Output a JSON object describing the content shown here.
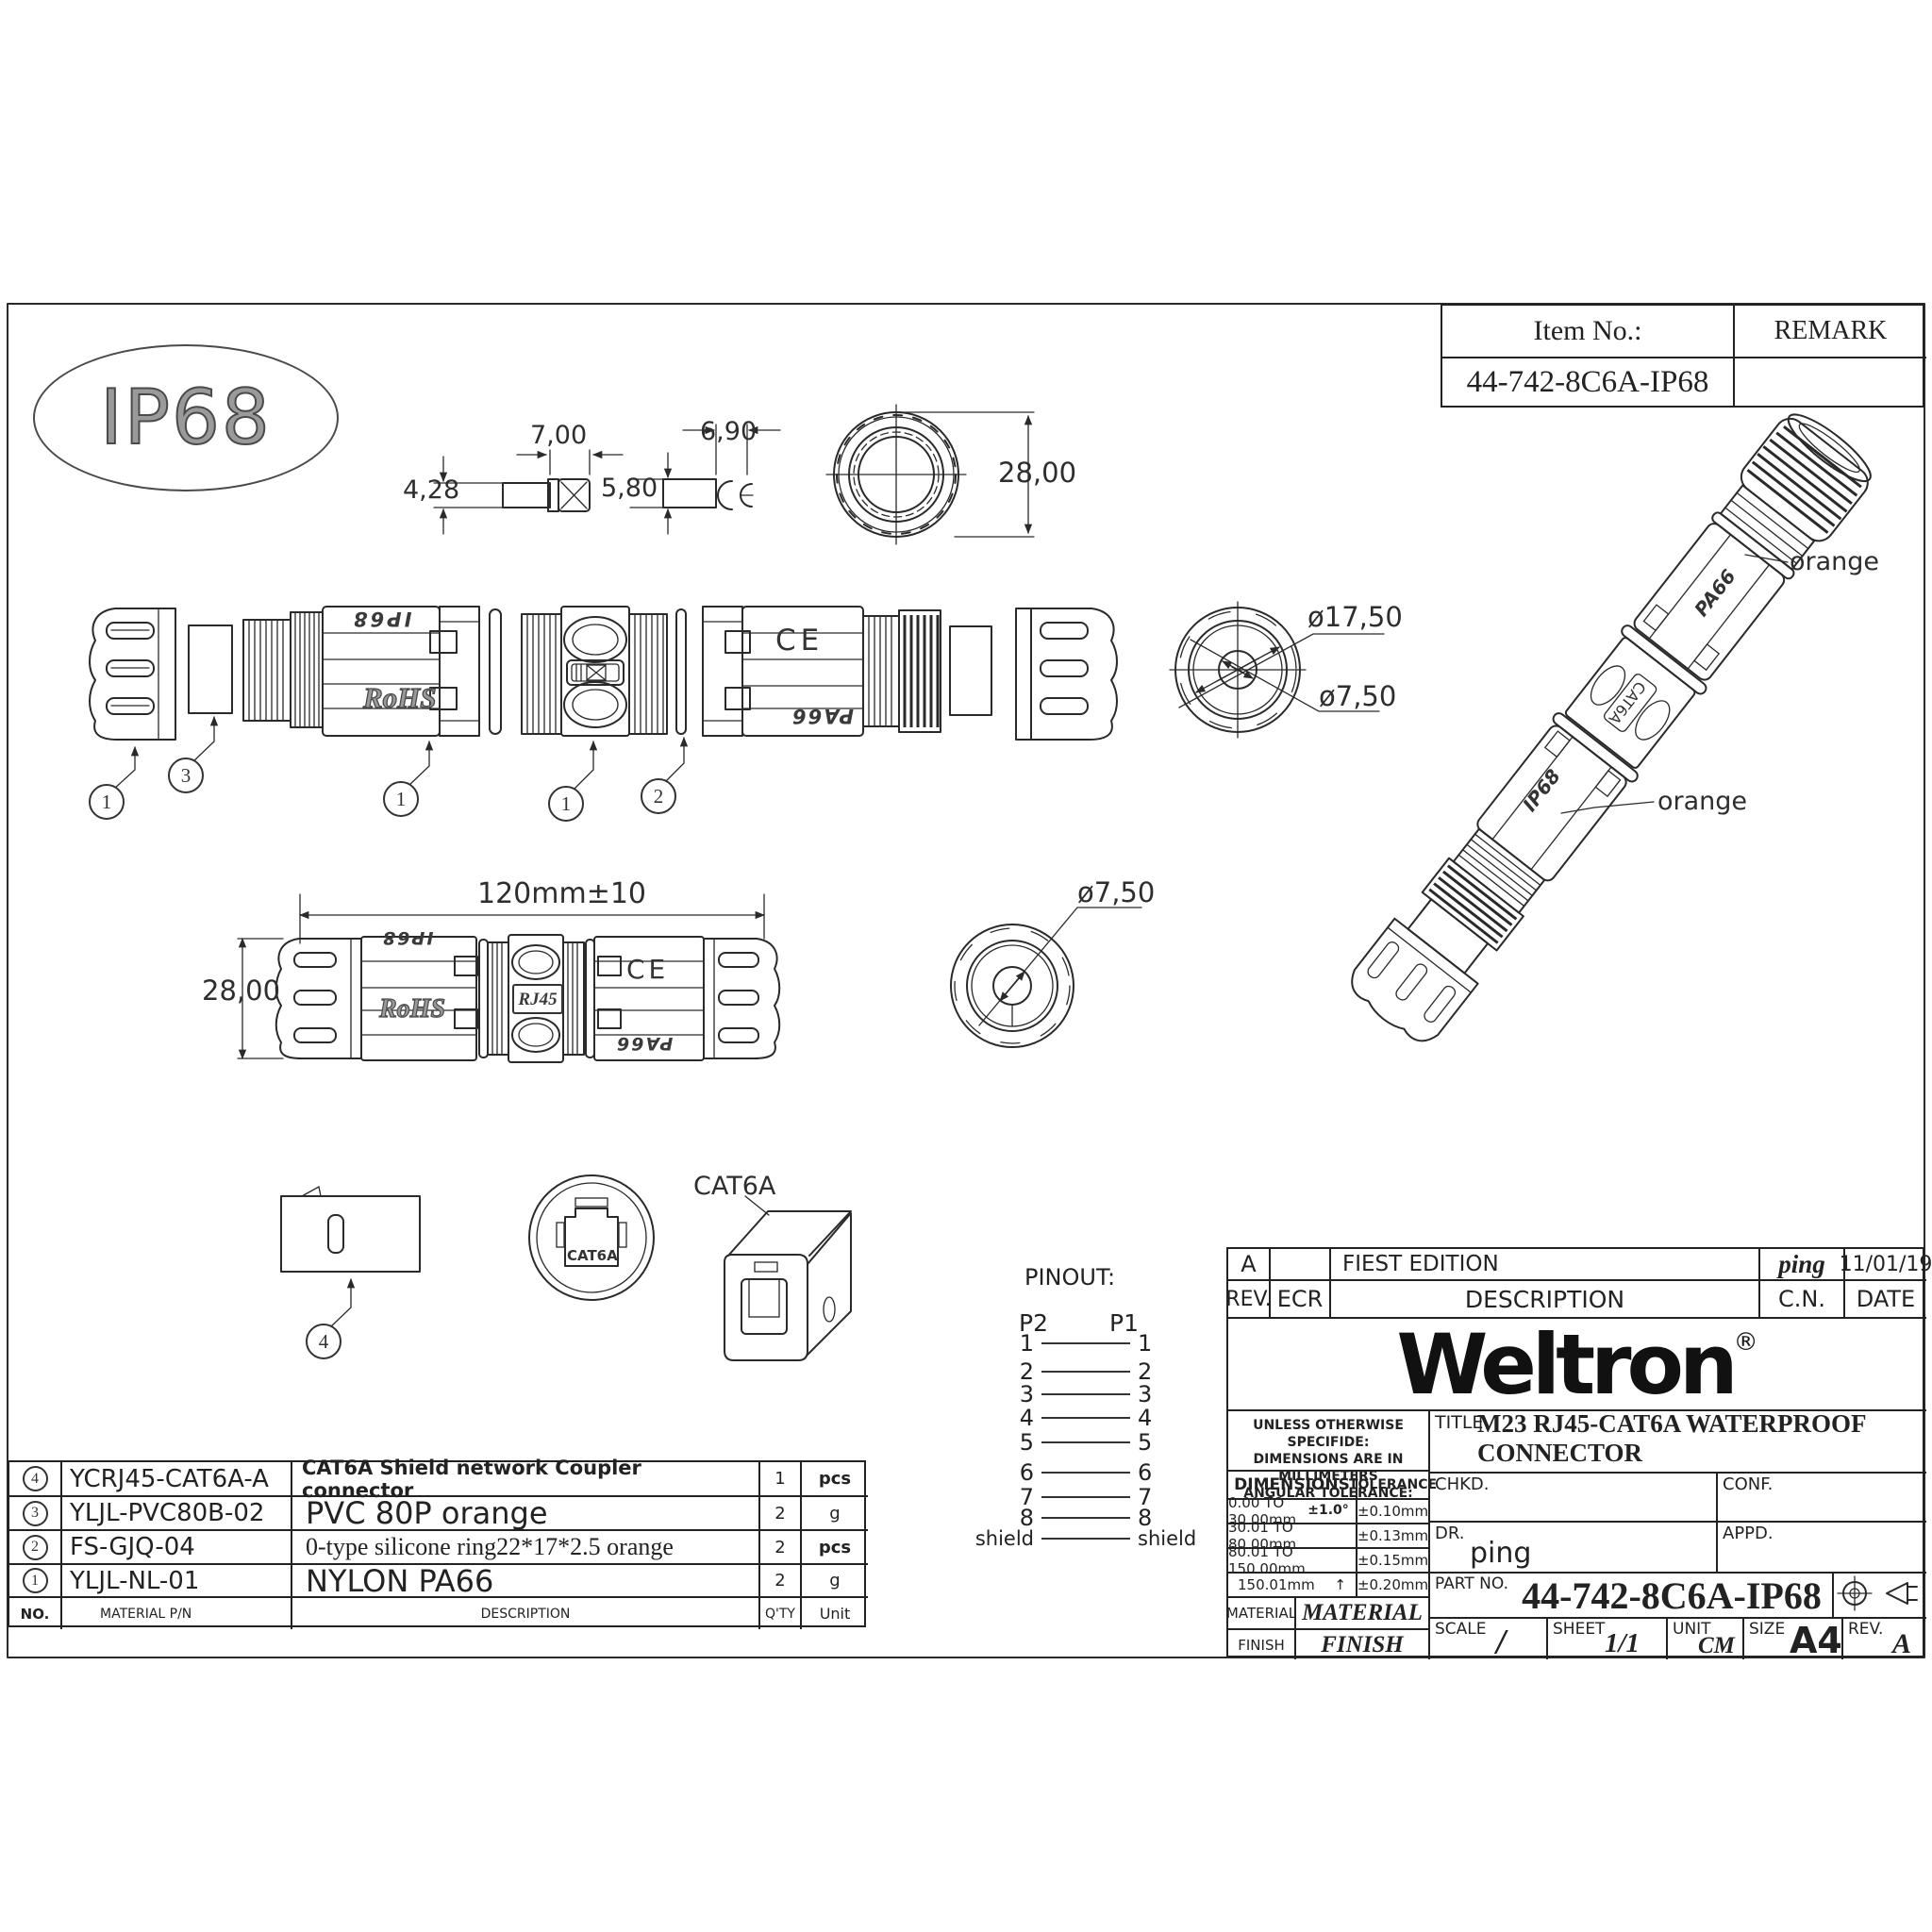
{
  "item_block": {
    "item_no_label": "Item No.:",
    "item_no_value": "44-742-8C6A-IP68",
    "remark_label": "REMARK"
  },
  "badge": {
    "text": "IP68"
  },
  "dims": {
    "pin_len": "7,00",
    "pin_h": "4,28",
    "clip_len": "6,90",
    "clip_h": "5,80",
    "cap_od": "28,00",
    "ring_od": "ø17,50",
    "ring_id": "ø7,50",
    "overall_len": "120mm±10",
    "body_od": "28,00",
    "knob_id": "ø7,50"
  },
  "callouts": {
    "c1": "1",
    "c2": "2",
    "c3": "3",
    "c4": "4"
  },
  "markings": {
    "ip68": "IP68",
    "rohs": "RoHS",
    "ce": "CE",
    "pa66": "PA66",
    "rj45": "RJ45",
    "cat6a": "CAT6A"
  },
  "labels": {
    "orange_top": "orange",
    "orange_mid": "orange",
    "cat6a": "CAT6A"
  },
  "pinout": {
    "title": "PINOUT:",
    "p2": "P2",
    "p1": "P1",
    "rows": [
      "1",
      "2",
      "3",
      "4",
      "5",
      "6",
      "7",
      "8",
      "shield"
    ]
  },
  "parts_table": {
    "header": {
      "no": "NO.",
      "pn": "MATERIAL P/N",
      "desc": "DESCRIPTION",
      "qty": "Q'TY",
      "unit": "Unit"
    },
    "rows": [
      {
        "no": "4",
        "pn": "YCRJ45-CAT6A-A",
        "desc": "CAT6A Shield network Coupler connector",
        "qty": "1",
        "unit": "pcs"
      },
      {
        "no": "3",
        "pn": "YLJL-PVC80B-02",
        "desc": "PVC 80P orange",
        "qty": "2",
        "unit": "g"
      },
      {
        "no": "2",
        "pn": "FS-GJQ-04",
        "desc": "0-type silicone ring22*17*2.5 orange",
        "qty": "2",
        "unit": "pcs"
      },
      {
        "no": "1",
        "pn": "YLJL-NL-01",
        "desc": "NYLON PA66",
        "qty": "2",
        "unit": "g"
      }
    ]
  },
  "title_block": {
    "rev_value": "A",
    "edition": "FIEST EDITION",
    "signed": "ping",
    "date_value": "11/01/19",
    "rev_label": "REV.",
    "ecr_label": "ECR",
    "description_label": "DESCRIPTION",
    "cn_label": "C.N.",
    "date_label": "DATE",
    "brand": "Weltron",
    "reg": "®",
    "note1": "UNLESS OTHERWISE SPECIFIDE:",
    "note2": "DIMENSIONS ARE IN MILLIMETERS",
    "note3": "ANGULAR TOLERANCE: ±1.0°",
    "dims_header": "DIMENSIONS",
    "tol_header": "TOLERANCE",
    "tol_rows": [
      {
        "range": "0.00 TO 30.00mm",
        "tol": "±0.10mm"
      },
      {
        "range": "30.01 TO 80.00mm",
        "tol": "±0.13mm"
      },
      {
        "range": "80.01 TO 150.00mm",
        "tol": "±0.15mm"
      },
      {
        "range": "150.01mm",
        "tol": "±0.20mm"
      }
    ],
    "tol_arrow": "↑",
    "title_label": "TITLE",
    "title_value": "M23 RJ45-CAT6A WATERPROOF CONNECTOR",
    "chkd_label": "CHKD.",
    "conf_label": "CONF.",
    "dr_label": "DR.",
    "dr_value": "ping",
    "appd_label": "APPD.",
    "part_no_label": "PART NO.",
    "part_no_value": "44-742-8C6A-IP68",
    "material_label": "MATERIAL",
    "material_value": "MATERIAL",
    "finish_label": "FINISH",
    "finish_value": "FINISH",
    "scale_label": "SCALE",
    "scale_value": "/",
    "sheet_label": "SHEET",
    "sheet_value": "1/1",
    "unit_label": "UNIT",
    "unit_value": "CM",
    "size_label": "SIZE",
    "size_value": "A4",
    "rev2_label": "REV.",
    "rev2_value": "A"
  }
}
